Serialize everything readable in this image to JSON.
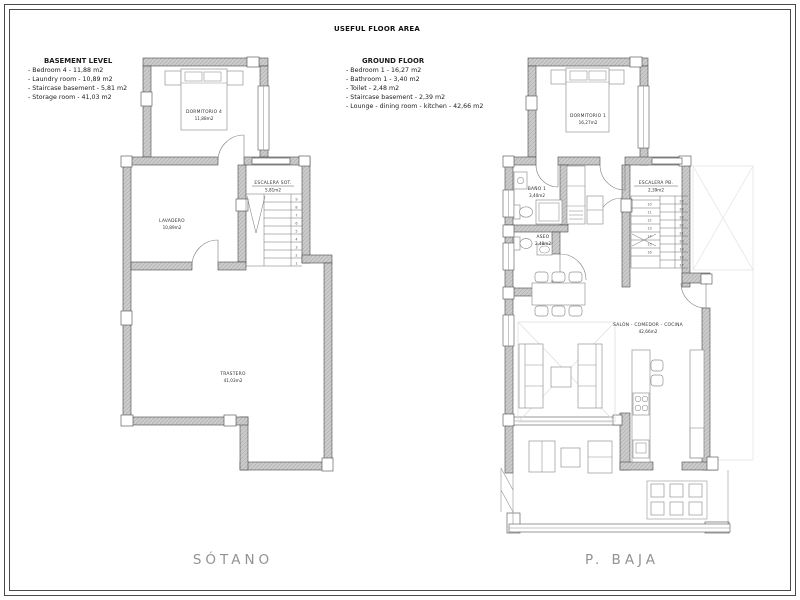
{
  "sheet": {
    "title": "USEFUL FLOOR AREA"
  },
  "legend_basement": {
    "title": "BASEMENT LEVEL",
    "items": [
      "- Bedroom 4 - 11,88 m2",
      "- Laundry room - 10,89 m2",
      "- Staircase basement - 5,81 m2",
      "- Storage room - 41,03 m2"
    ]
  },
  "legend_ground": {
    "title": "GROUND FLOOR",
    "items": [
      "- Bedroom 1 - 16,27 m2",
      "- Bathroom 1 - 3,40 m2",
      "- Toilet - 2,48 m2",
      "- Staircase basement - 2,39 m2",
      "- Lounge - dining room - kitchen - 42,66 m2"
    ]
  },
  "plans": {
    "sotano": {
      "caption": "SÓTANO",
      "rooms": {
        "dormitorio4": {
          "name": "DORMITORIO 4",
          "area": "11,88m2"
        },
        "lavadero": {
          "name": "LAVADERO",
          "area": "10,89m2"
        },
        "escalera": {
          "name": "ESCALERA SOT.",
          "area": "5,81m2"
        },
        "trastero": {
          "name": "TRASTERO",
          "area": "41,03m2"
        }
      },
      "stair_numbers_top_to_bottom": [
        "9",
        "8",
        "7",
        "6",
        "5",
        "4",
        "3",
        "2",
        "1"
      ]
    },
    "pbaja": {
      "caption": "P. BAJA",
      "rooms": {
        "dormitorio1": {
          "name": "DORMITORIO 1",
          "area": "16,27m2"
        },
        "bano": {
          "name": "BAÑO 1",
          "area": "3,40m2"
        },
        "aseo": {
          "name": "ASEO",
          "area": "2,48m2"
        },
        "escalera": {
          "name": "ESCALERA PB.",
          "area": "2,39m2"
        },
        "salon": {
          "name": "SALÓN - COMEDOR - COCINA",
          "area": "42,66m2"
        }
      },
      "stair_numbers_left_top_to_bottom": [
        "10",
        "11",
        "12",
        "13",
        "14",
        "15",
        "16"
      ],
      "stair_numbers_right_top_to_bottom": [
        "25",
        "24",
        "23",
        "22",
        "21",
        "20",
        "19",
        "18",
        "17"
      ]
    }
  },
  "colors": {
    "wall_fill": "#cdcdcd",
    "wall_line": "#4a4a4a",
    "furniture_line": "#949494",
    "faint_projection": "#e2e2e2",
    "caption_text": "#929292"
  }
}
